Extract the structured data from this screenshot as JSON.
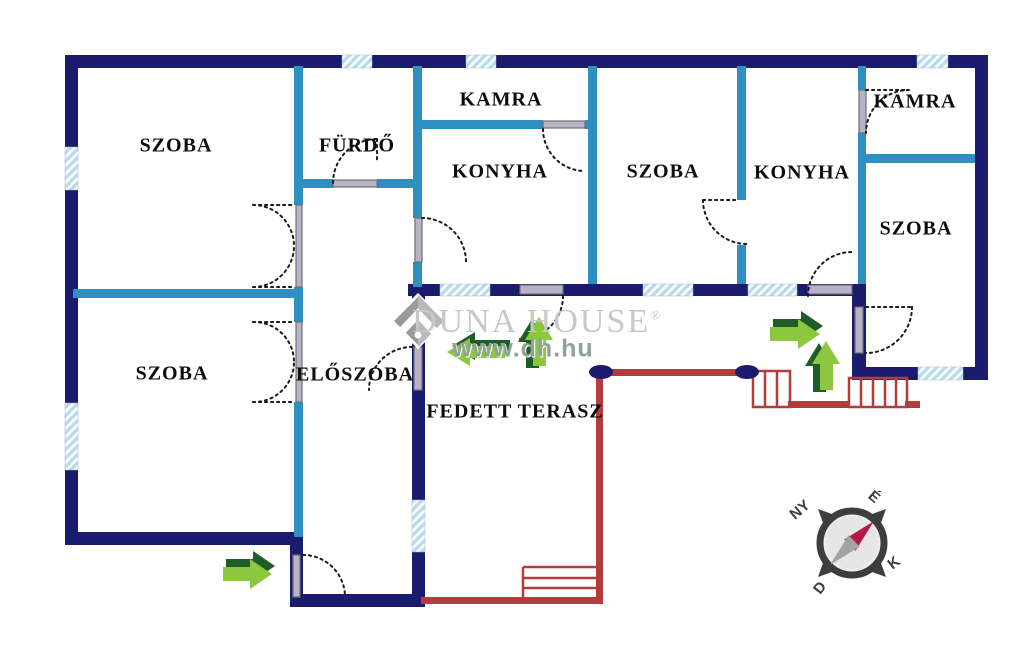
{
  "rooms": [
    {
      "id": "szoba-top-left",
      "label": "SZOBA"
    },
    {
      "id": "furdo",
      "label": "FÜRDŐ"
    },
    {
      "id": "kamra-middle",
      "label": "KAMRA"
    },
    {
      "id": "konyha-middle",
      "label": "KONYHA"
    },
    {
      "id": "szoba-middle",
      "label": "SZOBA"
    },
    {
      "id": "konyha-right",
      "label": "KONYHA"
    },
    {
      "id": "kamra-right",
      "label": "KAMRA"
    },
    {
      "id": "szoba-right",
      "label": "SZOBA"
    },
    {
      "id": "szoba-bottom-left",
      "label": "SZOBA"
    },
    {
      "id": "eloszoba",
      "label": "ELŐSZOBA"
    },
    {
      "id": "fedett-terasz",
      "label": "FEDETT TERASZ"
    }
  ],
  "watermark": {
    "brand": "DUNA HOUSE",
    "registered_mark": "®",
    "website": "www.dh.hu"
  },
  "compass": {
    "north": "É",
    "south": "D",
    "east": "K",
    "west": "NY"
  },
  "colors": {
    "outer_wall": "#1b1b6e",
    "inner_wall": "#2e8fc1",
    "window_fill": "#b9dbee",
    "door_sill": "#b9b2c6",
    "terrace_line": "#b23d3d",
    "entry_arrow_light": "#8dc63f",
    "entry_arrow_dark": "#1e5c28",
    "compass_needle": "#b51947"
  }
}
